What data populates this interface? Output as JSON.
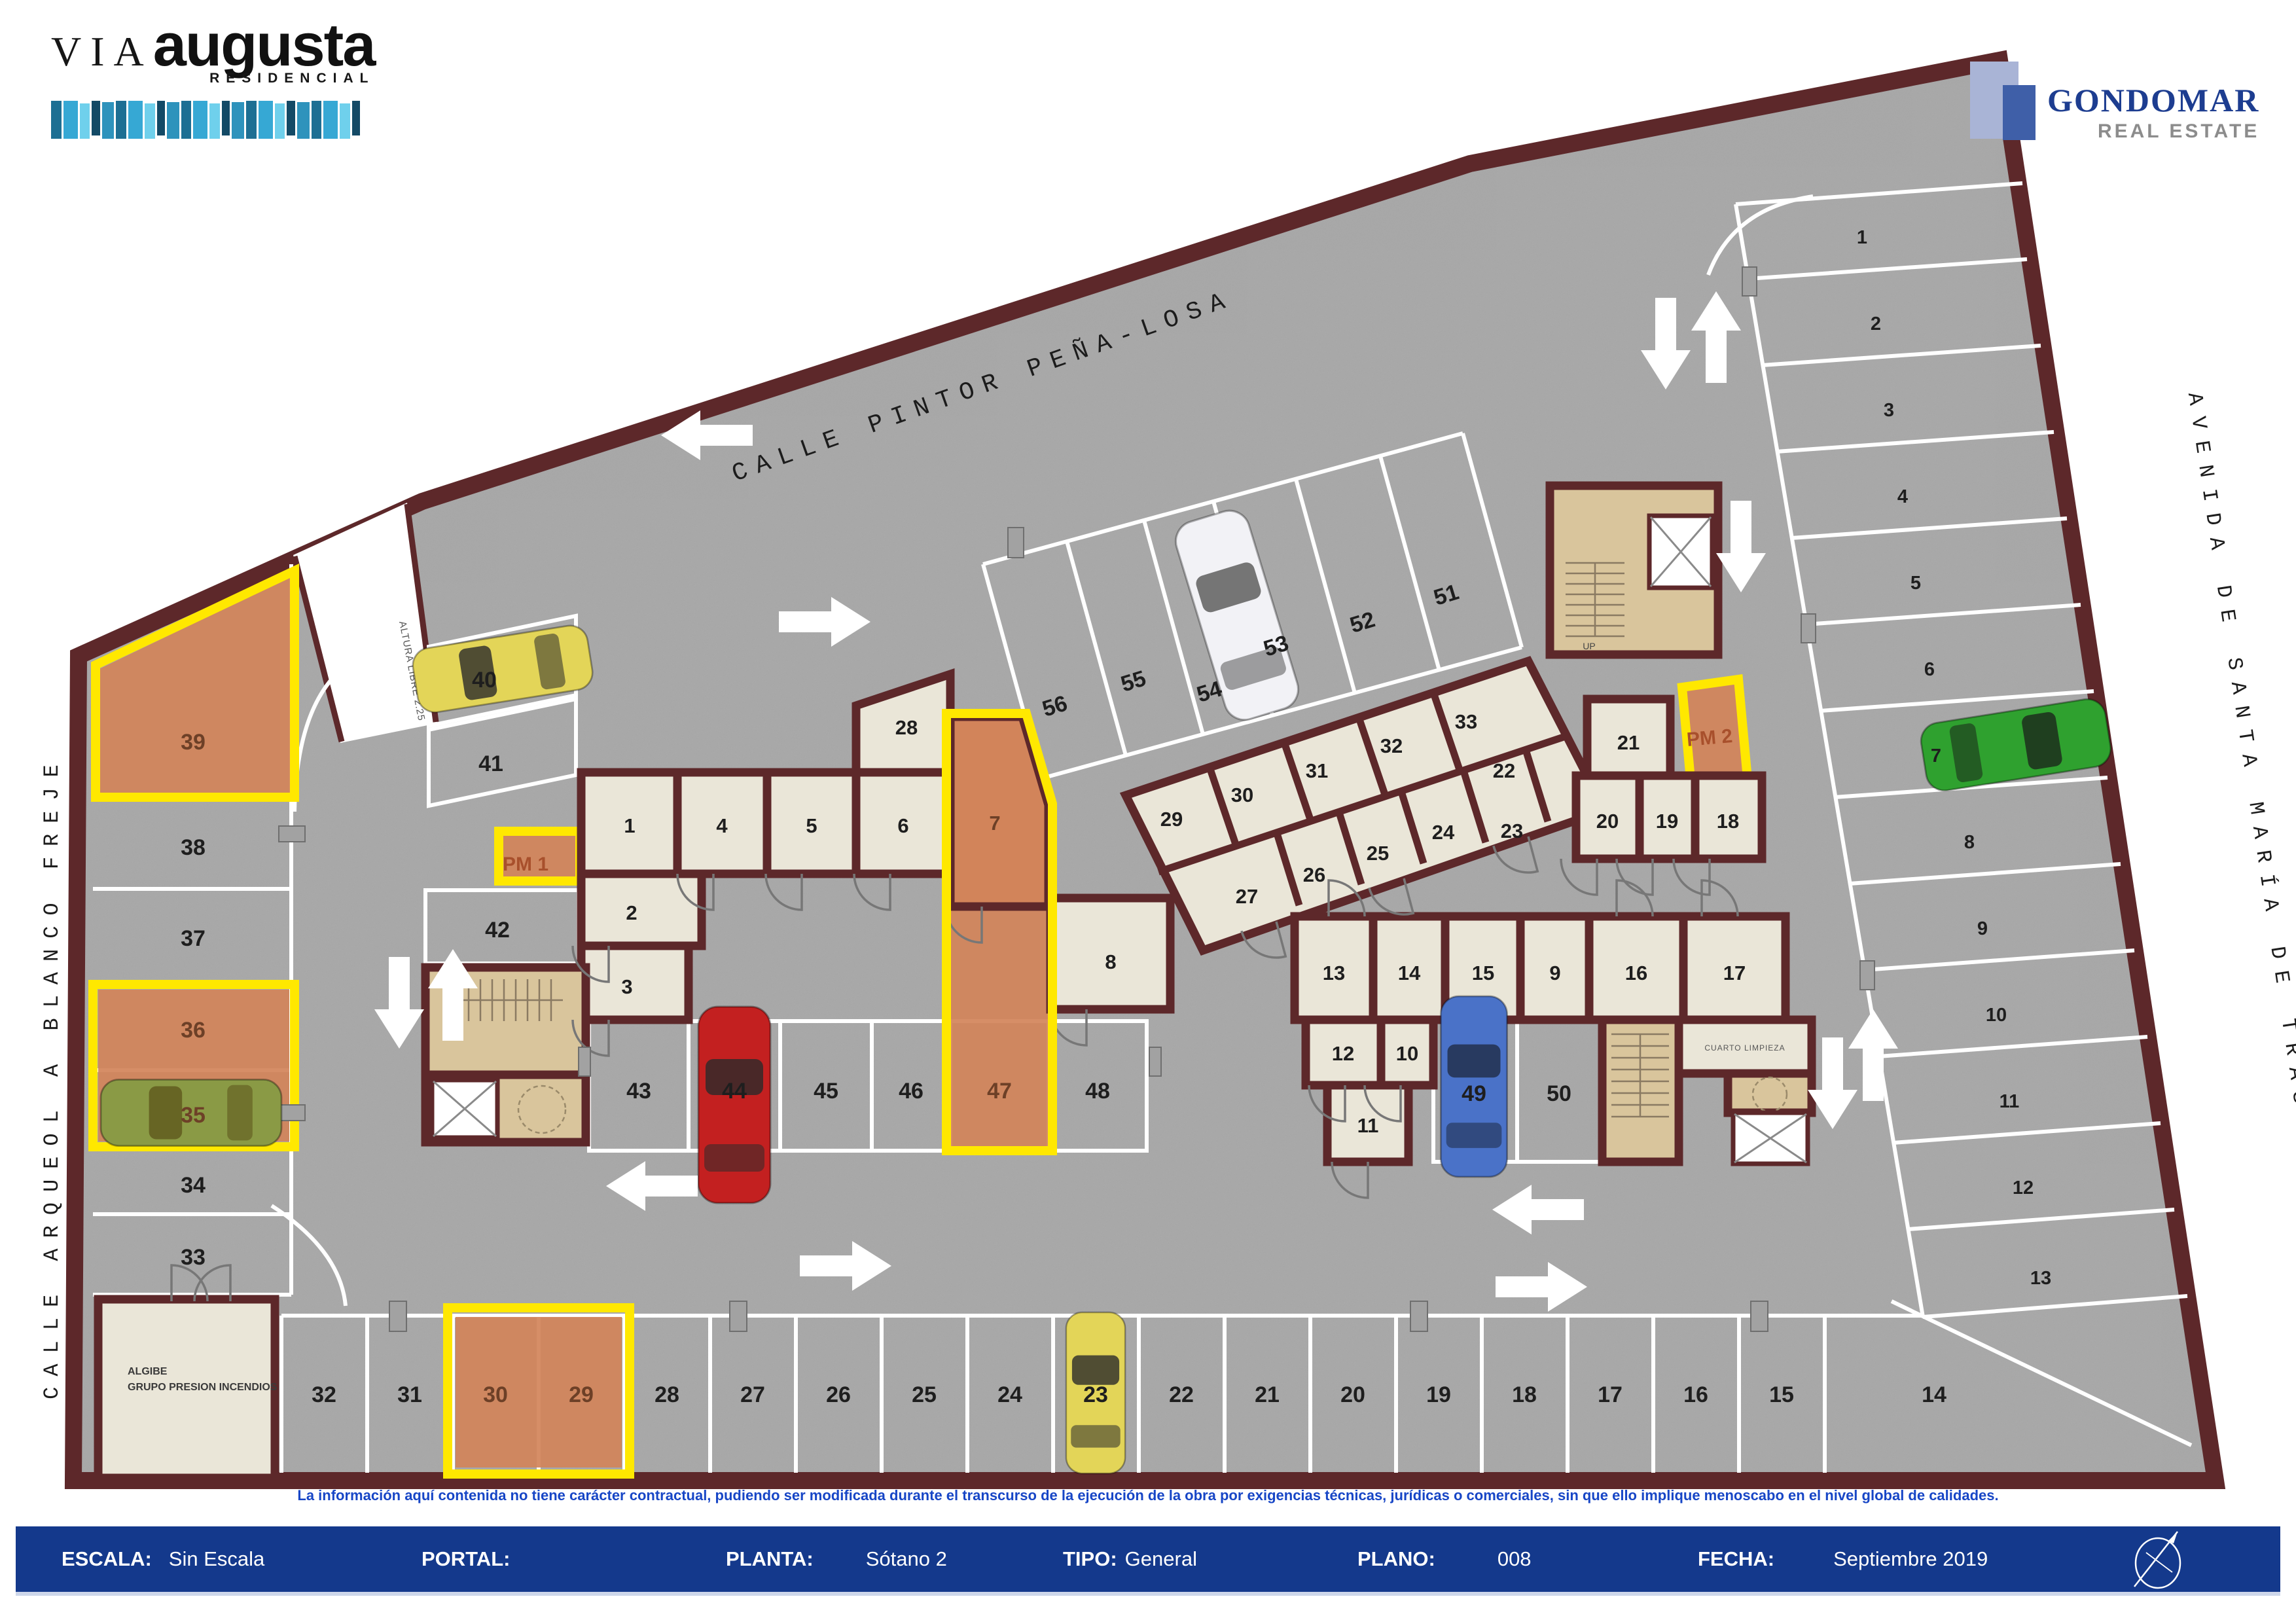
{
  "header": {
    "brand": {
      "via": "VIA",
      "augusta": "augusta",
      "residencial": "RESIDENCIAL"
    },
    "realtor": {
      "name": "GONDOMAR",
      "tagline": "REAL ESTATE"
    }
  },
  "streets": {
    "top": "CALLE PINTOR PEÑA-LOSA",
    "left": "CALLE ARQUEOL A BLANCO FREJE",
    "right": "AVENIDA DE SANTA MARÍA DE TRASIERRA"
  },
  "plan": {
    "spots": {
      "left_column": [
        "39",
        "38",
        "37",
        "36",
        "35",
        "34",
        "33"
      ],
      "upper_left": [
        "40",
        "41",
        "42"
      ],
      "top_row": [
        "56",
        "55",
        "54",
        "53",
        "52",
        "51"
      ],
      "center_row": [
        "43",
        "44",
        "45",
        "46",
        "47",
        "48"
      ],
      "mid_right": [
        "49",
        "50"
      ],
      "right_column": [
        "1",
        "2",
        "3",
        "4",
        "5",
        "6",
        "7",
        "8",
        "9",
        "10",
        "11",
        "12",
        "13"
      ],
      "bottom_row": [
        "32",
        "31",
        "30",
        "29",
        "28",
        "27",
        "26",
        "25",
        "24",
        "23",
        "22",
        "21",
        "20",
        "19",
        "18",
        "17",
        "16",
        "15",
        "14"
      ],
      "pm1": "PM 1",
      "pm2": "PM 2"
    },
    "trasteros": {
      "main_row": [
        "1",
        "4",
        "5",
        "6",
        "7"
      ],
      "left_stack": [
        "2",
        "3"
      ],
      "top_room": "28",
      "room8": "8",
      "upper_top": [
        "29",
        "30",
        "31",
        "32",
        "33"
      ],
      "upper_bottom": [
        "27",
        "26",
        "25",
        "24",
        "23"
      ],
      "upper_mid": "22",
      "right_group": [
        "21",
        "20",
        "19",
        "18"
      ],
      "mid_top": [
        "13",
        "14",
        "15",
        "9",
        "16",
        "17"
      ],
      "mid_mid": [
        "12",
        "10"
      ],
      "mid_bottom": "11"
    },
    "rooms": {
      "algibe1": "ALGIBE",
      "algibe2": "GRUPO PRESION INCENDIOS",
      "cuarto_limpieza": "CUARTO LIMPIEZA",
      "ramp": "ALTURA LIBRE 2.25",
      "up": "UP"
    }
  },
  "footer": {
    "disclaimer": "La información aquí contenida no tiene carácter contractual, pudiendo ser modificada durante el transcurso de la ejecución de la obra por exigencias técnicas, jurídicas o comerciales, sin que ello implique menoscabo en el nivel global de calidades.",
    "fields": [
      {
        "label": "ESCALA:",
        "value": "Sin Escala"
      },
      {
        "label": "PORTAL:",
        "value": ""
      },
      {
        "label": "PLANTA:",
        "value": "Sótano 2"
      },
      {
        "label": "TIPO:",
        "value": "General"
      },
      {
        "label": "PLANO:",
        "value": "008"
      },
      {
        "label": "FECHA:",
        "value": "Septiembre 2019"
      }
    ]
  },
  "colors": {
    "wall": "#5d282a",
    "floor": "#ababab",
    "room": "#eae6d8",
    "core": "#d9c59c",
    "highlight": "#d2845a",
    "highlight_outline": "#ffe800",
    "footer_bar": "#14398c",
    "accent_navy": "#1d3d90",
    "disclaimer_blue": "#1746c6"
  }
}
